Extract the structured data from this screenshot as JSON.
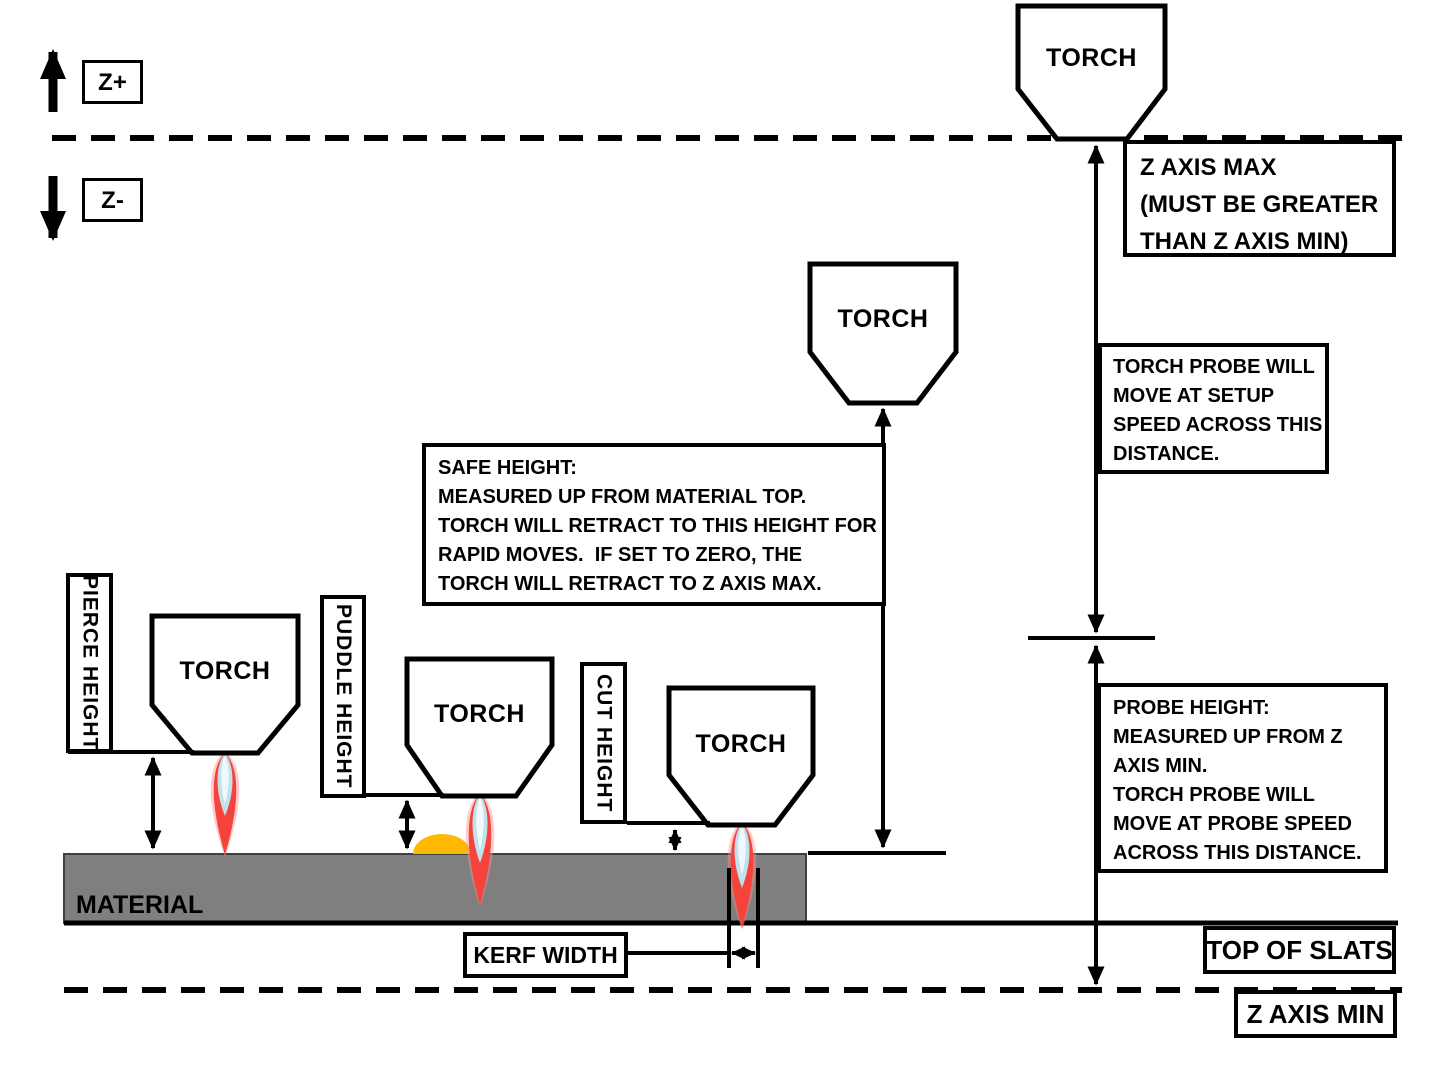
{
  "axis": {
    "z_plus": "Z+",
    "z_minus": "Z-"
  },
  "torch_label": "TORCH",
  "material_label": "MATERIAL",
  "labels": {
    "pierce_height": "PIERCE HEIGHT",
    "puddle_height": "PUDDLE HEIGHT",
    "cut_height": "CUT HEIGHT",
    "kerf_width": "KERF WIDTH",
    "top_of_slats": "TOP OF SLATS",
    "z_axis_min": "Z AXIS MIN"
  },
  "callouts": {
    "z_axis_max": "Z AXIS MAX\n(MUST BE GREATER\nTHAN Z AXIS MIN)",
    "torch_probe": "TORCH PROBE WILL\nMOVE AT SETUP\nSPEED ACROSS THIS\nDISTANCE.",
    "safe_height": "SAFE HEIGHT:\nMEASURED UP FROM MATERIAL TOP.\nTORCH WILL RETRACT TO THIS HEIGHT FOR\nRAPID MOVES.  IF SET TO ZERO, THE\nTORCH WILL RETRACT TO Z AXIS MAX.",
    "probe_height": "PROBE HEIGHT:\nMEASURED UP FROM Z\nAXIS MIN.\nTORCH PROBE WILL\nMOVE AT PROBE SPEED\nACROSS THIS DISTANCE."
  },
  "colors": {
    "line": "#000000",
    "material": "#7F7F7F",
    "material_edge": "#3F3F3F",
    "puddle": "#FFB900",
    "flame_glow": "#FF8F8C",
    "flame_outer": "#F5433B",
    "flame_inner": "#BFE2EB",
    "flame_core": "#EFF9FD",
    "torch_fill": "#FFFFFF"
  }
}
